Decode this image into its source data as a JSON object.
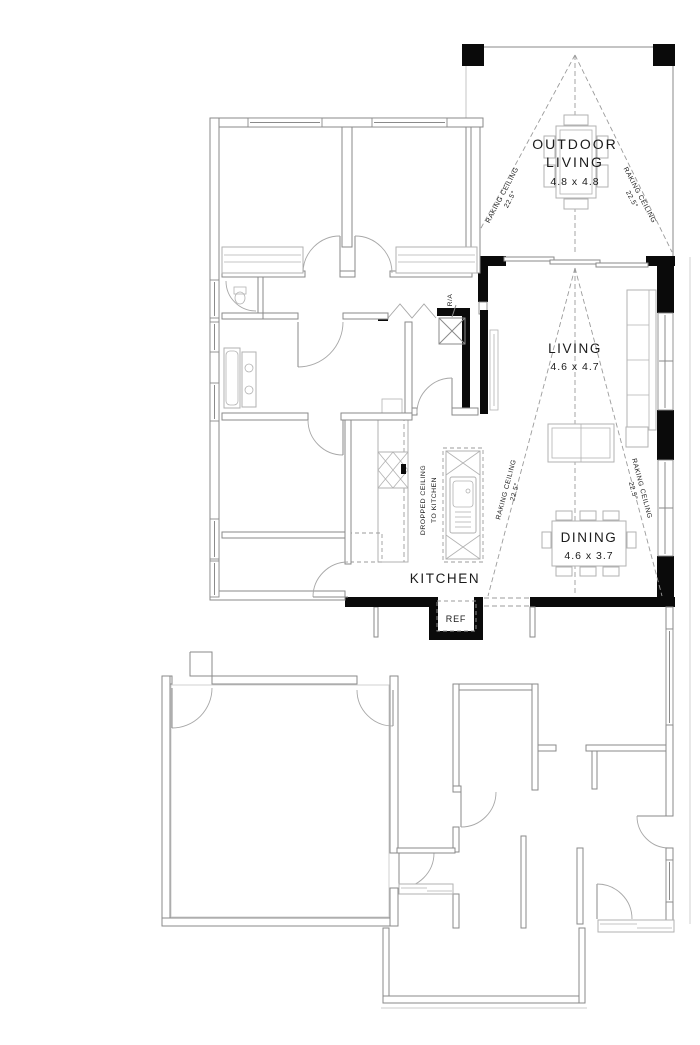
{
  "rooms": {
    "outdoor_living": {
      "label1": "OUTDOOR",
      "label2": "LIVING",
      "dims": "4.8 x 4.8"
    },
    "living": {
      "label": "LIVING",
      "dims": "4.6 x 4.7"
    },
    "dining": {
      "label": "DINING",
      "dims": "4.6 x 3.7"
    },
    "kitchen": {
      "label": "KITCHEN"
    }
  },
  "notes": {
    "raking_ceiling": "RAKING CEILING",
    "raking_angle": "22.5°",
    "dropped_ceiling_line1": "DROPPED CEILING",
    "dropped_ceiling_line2": "TO KITCHEN",
    "return_air": "R/A",
    "refrigerator": "REF"
  },
  "colors": {
    "wall_thin": "#8a8a8a",
    "wall_solid": "#0a0a0a",
    "dashed_line": "#9b9b9b",
    "furniture": "#b2b2b2",
    "text": "#1b1b1b",
    "background": "#ffffff"
  }
}
